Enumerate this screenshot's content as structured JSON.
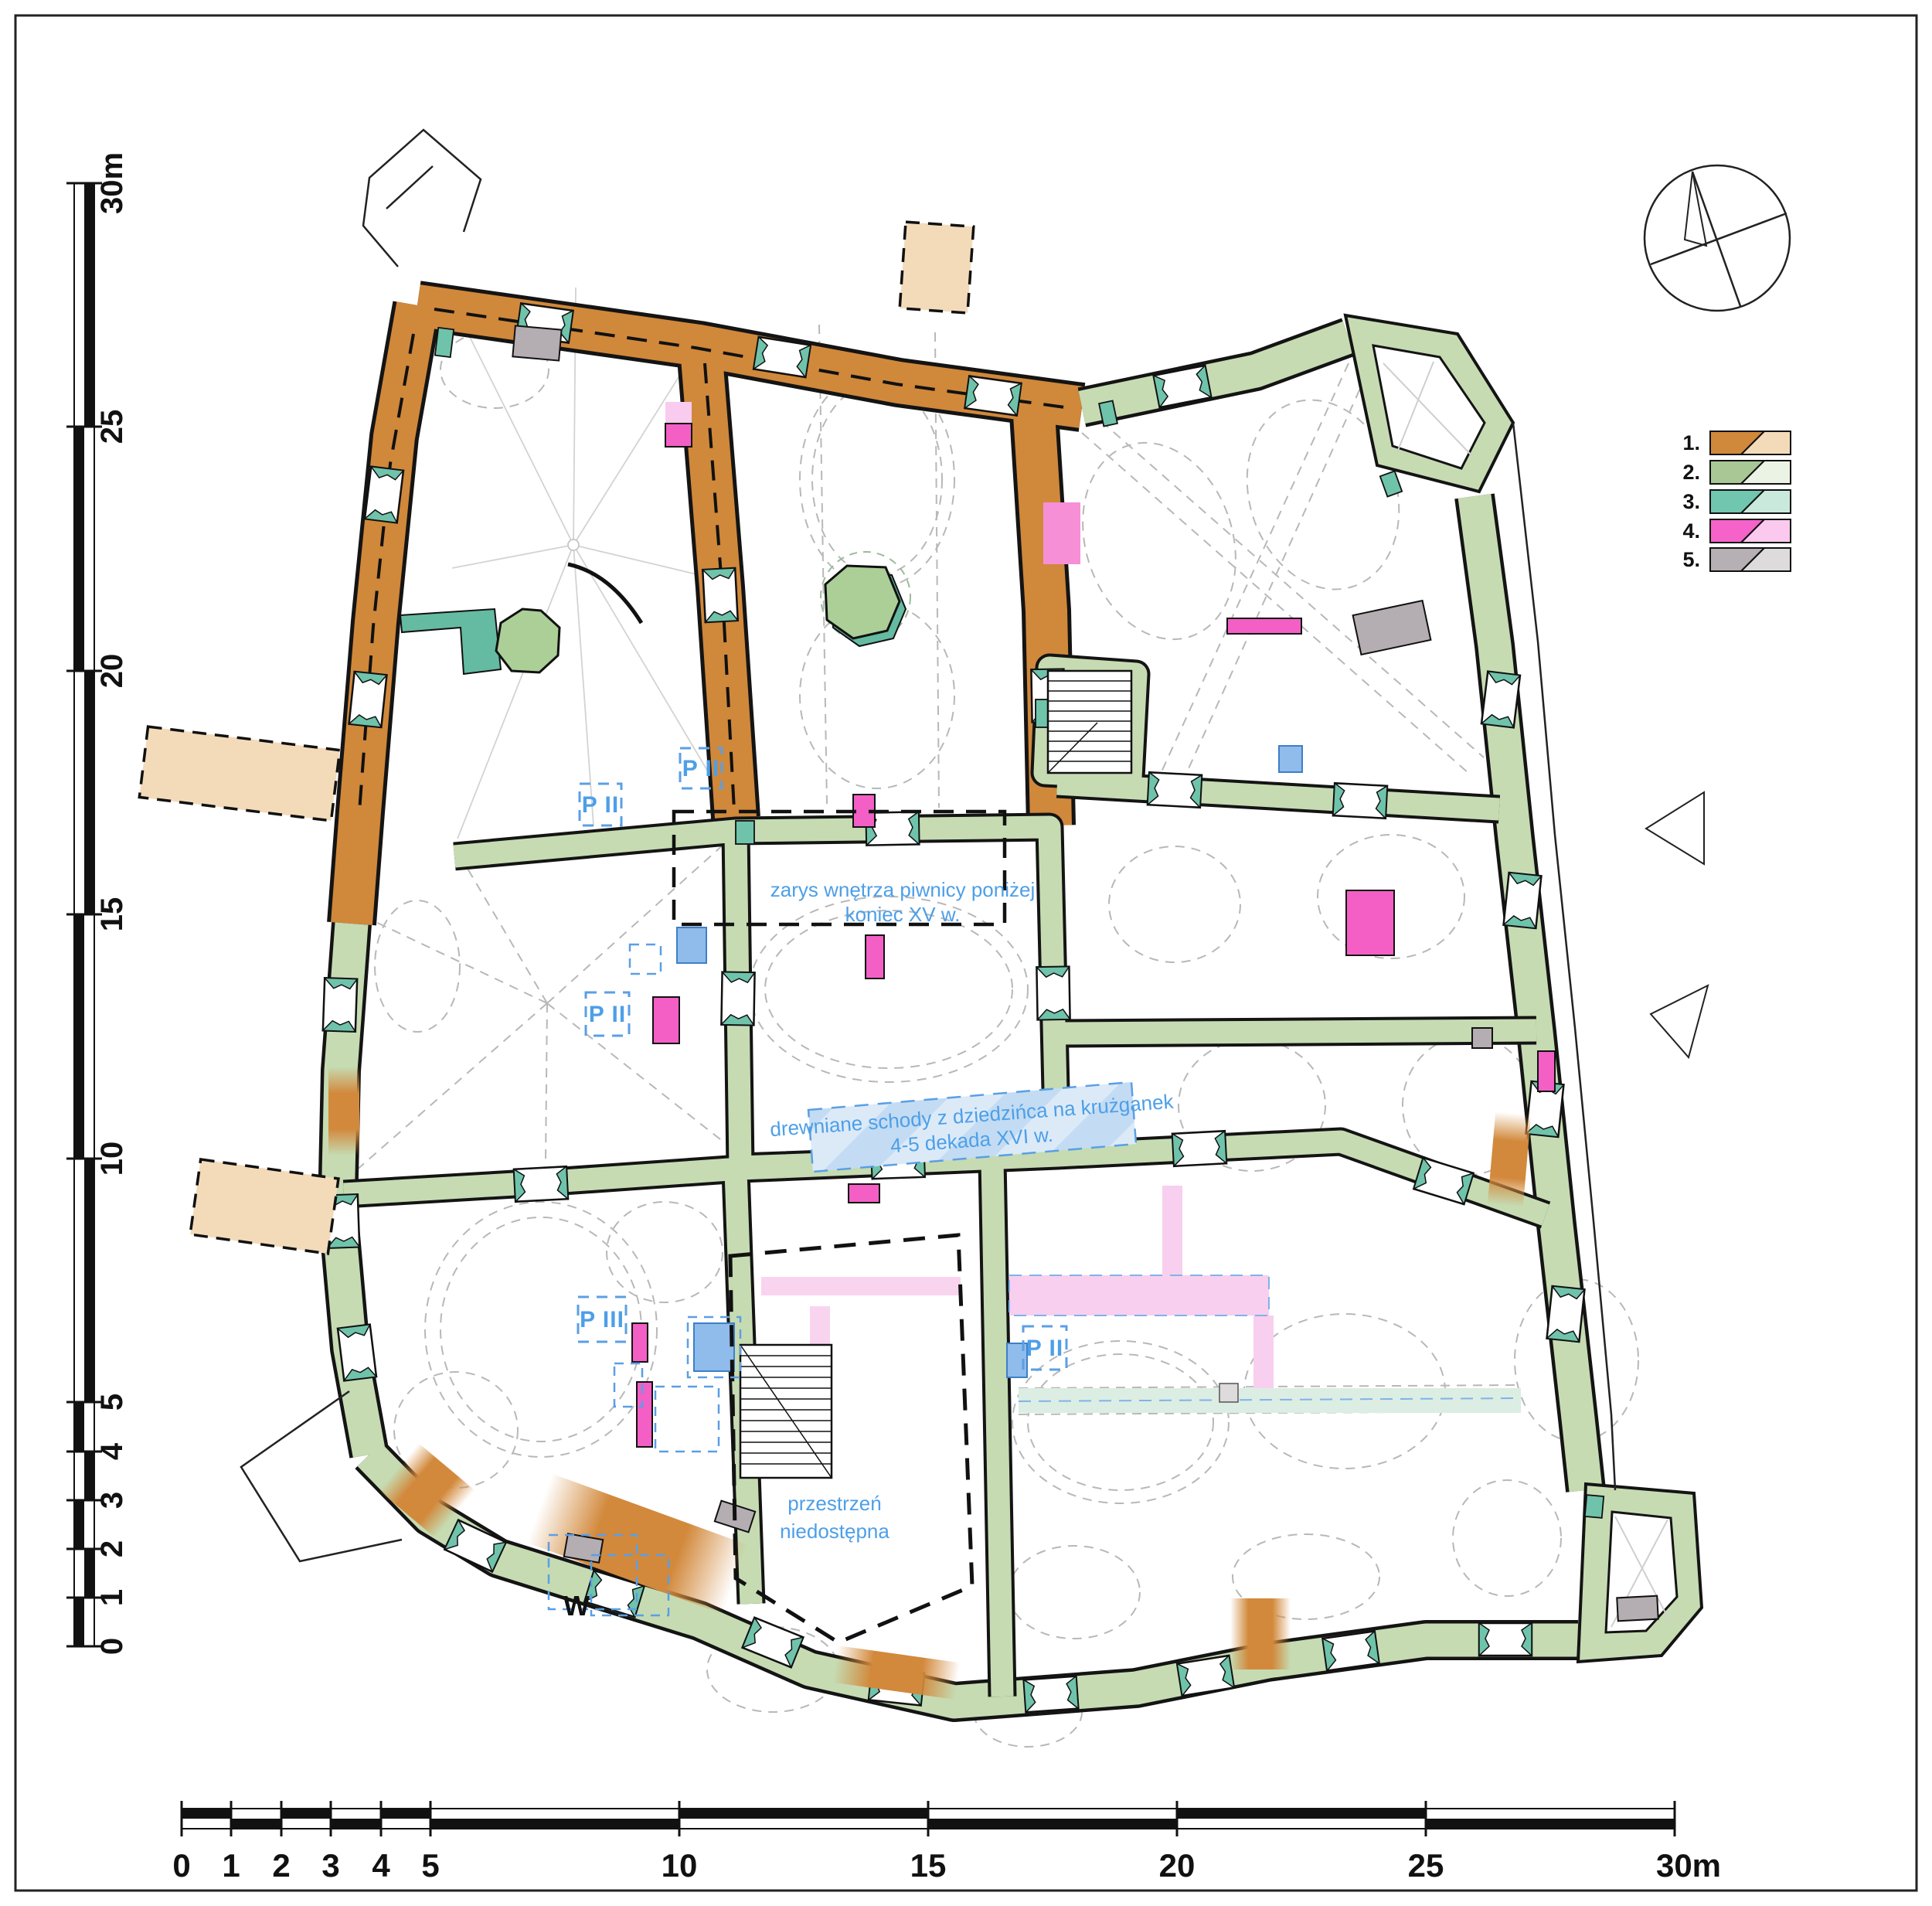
{
  "scale_vertical": {
    "labels": [
      "30m",
      "25",
      "20",
      "15",
      "10",
      "5",
      "4",
      "3",
      "2",
      "1",
      "0"
    ]
  },
  "scale_horizontal": {
    "labels": [
      "0",
      "1",
      "2",
      "3",
      "4",
      "5",
      "10",
      "15",
      "20",
      "25",
      "30m"
    ]
  },
  "legend": {
    "items": [
      {
        "label": "1.",
        "color": "#D0883B",
        "tint": "#F3DBBA"
      },
      {
        "label": "2.",
        "color": "#A8C794",
        "tint": "#EBF3E5"
      },
      {
        "label": "3.",
        "color": "#70C6AE",
        "tint": "#C9E9DD"
      },
      {
        "label": "4.",
        "color": "#F562C9",
        "tint": "#FCC9EE"
      },
      {
        "label": "5.",
        "color": "#B6AFB3",
        "tint": "#DEDBDC"
      }
    ]
  },
  "annotations": {
    "cellar_outline": {
      "line1": "zarys wnętrza piwnicy poniżej",
      "line2": "koniec XV w."
    },
    "wooden_stairs": {
      "line1": "drewniane schody z dziedzińca na krużganek",
      "line2": "4-5 dekada XVI w."
    },
    "inaccessible": {
      "line1": "przestrzeń",
      "line2": "niedostępna"
    },
    "p2_a": "P II",
    "p2_b": "P II",
    "p2_c": "P II",
    "p2_d": "P II",
    "p3": "P III",
    "entrance": "W"
  },
  "colors": {
    "phase1": "#D0883B",
    "phase1_tint": "#F3DBBA",
    "phase2": "#C6DBB2",
    "phase2_legend": "#A8C794",
    "phase2_tint": "#EBF3E5",
    "phase3": "#70C6AE",
    "phase3_tint": "#C9E9DD",
    "phase4": "#F35FC5",
    "phase4_tint": "#FCC9EE",
    "phase5": "#B4ADB1",
    "phase5_tint": "#DEDBDC",
    "annotation_blue": "#4D9FE8"
  }
}
